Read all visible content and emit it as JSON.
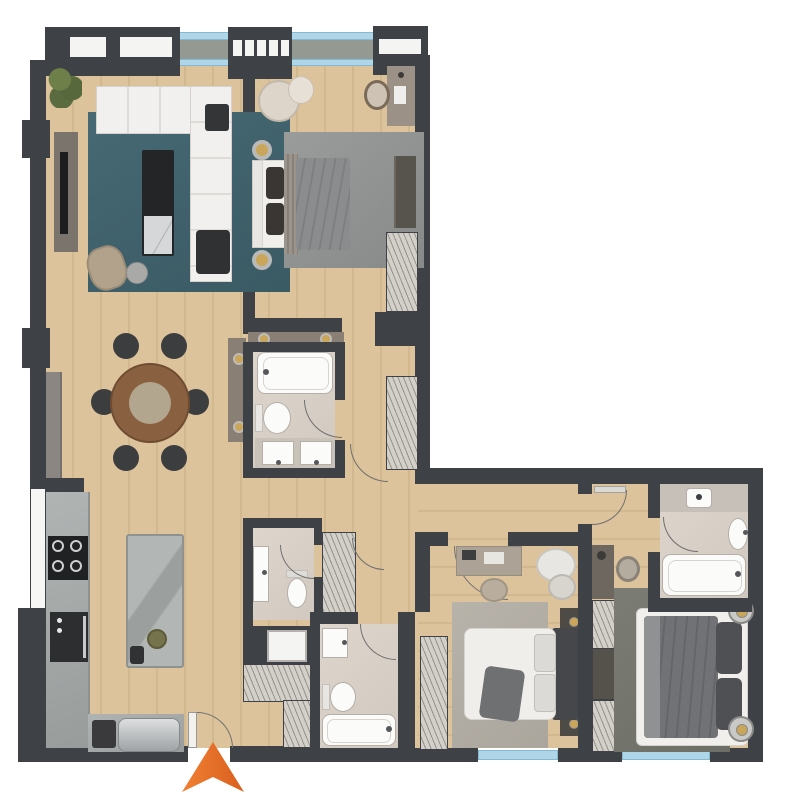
{
  "plan": {
    "title": "apartment-floor-plan",
    "style": "top-down architectural render, unlabeled",
    "shape": "L-shaped unit with top-left wing and bottom wing"
  },
  "palette": {
    "wall": "#3e4145",
    "wood_floor": "#d8bf98",
    "marble_floor": "#d9d1c8",
    "counter_gray": "#a7abaa",
    "teal_rug": "#41626c",
    "gray_rug": "#939695",
    "light_rug": "#b3aea6",
    "dark_rug": "#75776f",
    "accent_gold": "#c9a659",
    "glass_blue": "#aed6e8",
    "balcony_concrete": "#949a91",
    "entrance_orange": "#e8702d"
  },
  "rooms": [
    {
      "name": "living-room",
      "furniture": [
        "corner-sofa",
        "coffee-table-with-marble-tray",
        "armchair",
        "round-side-table",
        "tv-console",
        "teal-area-rug",
        "plant"
      ]
    },
    {
      "name": "dining-area",
      "furniture": [
        "round-dining-table",
        "six-dining-chairs",
        "sideboard",
        "wall-sconce-panels"
      ]
    },
    {
      "name": "bedroom-1",
      "furniture": [
        "double-bed",
        "wall-sconces",
        "cream-armchair",
        "vanity-desk",
        "vanity-chair",
        "dresser",
        "two-wardrobes",
        "gray-area-rug"
      ]
    },
    {
      "name": "bathroom-1",
      "furniture": [
        "bathtub",
        "toilet",
        "double-sink-vanity"
      ]
    },
    {
      "name": "corridor",
      "furniture": [
        "built-in-wardrobe"
      ]
    },
    {
      "name": "kitchen",
      "furniture": [
        "wall-counter",
        "cooktop",
        "oven",
        "island-with-sink",
        "coffee-station",
        "metallic-appliance",
        "window"
      ]
    },
    {
      "name": "entry-hall",
      "furniture": [
        "entry-door",
        "shoe-closet"
      ]
    },
    {
      "name": "guest-wc",
      "furniture": [
        "washbasin",
        "toilet"
      ]
    },
    {
      "name": "laundry-niche",
      "furniture": [
        "washer"
      ]
    },
    {
      "name": "hall-closet",
      "furniture": [
        "shelving"
      ]
    },
    {
      "name": "bathroom-2",
      "furniture": [
        "washbasin",
        "toilet",
        "bathtub"
      ]
    },
    {
      "name": "bedroom-2",
      "furniture": [
        "double-bed",
        "two-nightstands",
        "desk",
        "pouf",
        "laundry-basket",
        "built-in-wardrobe",
        "light-area-rug",
        "window"
      ]
    },
    {
      "name": "master-bedroom",
      "furniture": [
        "double-bed",
        "two-bedside-lamps",
        "vanity-desk",
        "stool",
        "built-in-wardrobe",
        "dark-area-rug",
        "window"
      ]
    },
    {
      "name": "master-bathroom",
      "furniture": [
        "shower",
        "washbasin",
        "bathtub"
      ]
    }
  ],
  "balcony": {
    "position": "top",
    "elements": [
      "glass-railing",
      "concrete-slab",
      "three-window-frames",
      "sliding-glass-line"
    ]
  },
  "entrance": {
    "symbol": "orange-arrow",
    "direction": "up",
    "position": "bottom-center"
  }
}
